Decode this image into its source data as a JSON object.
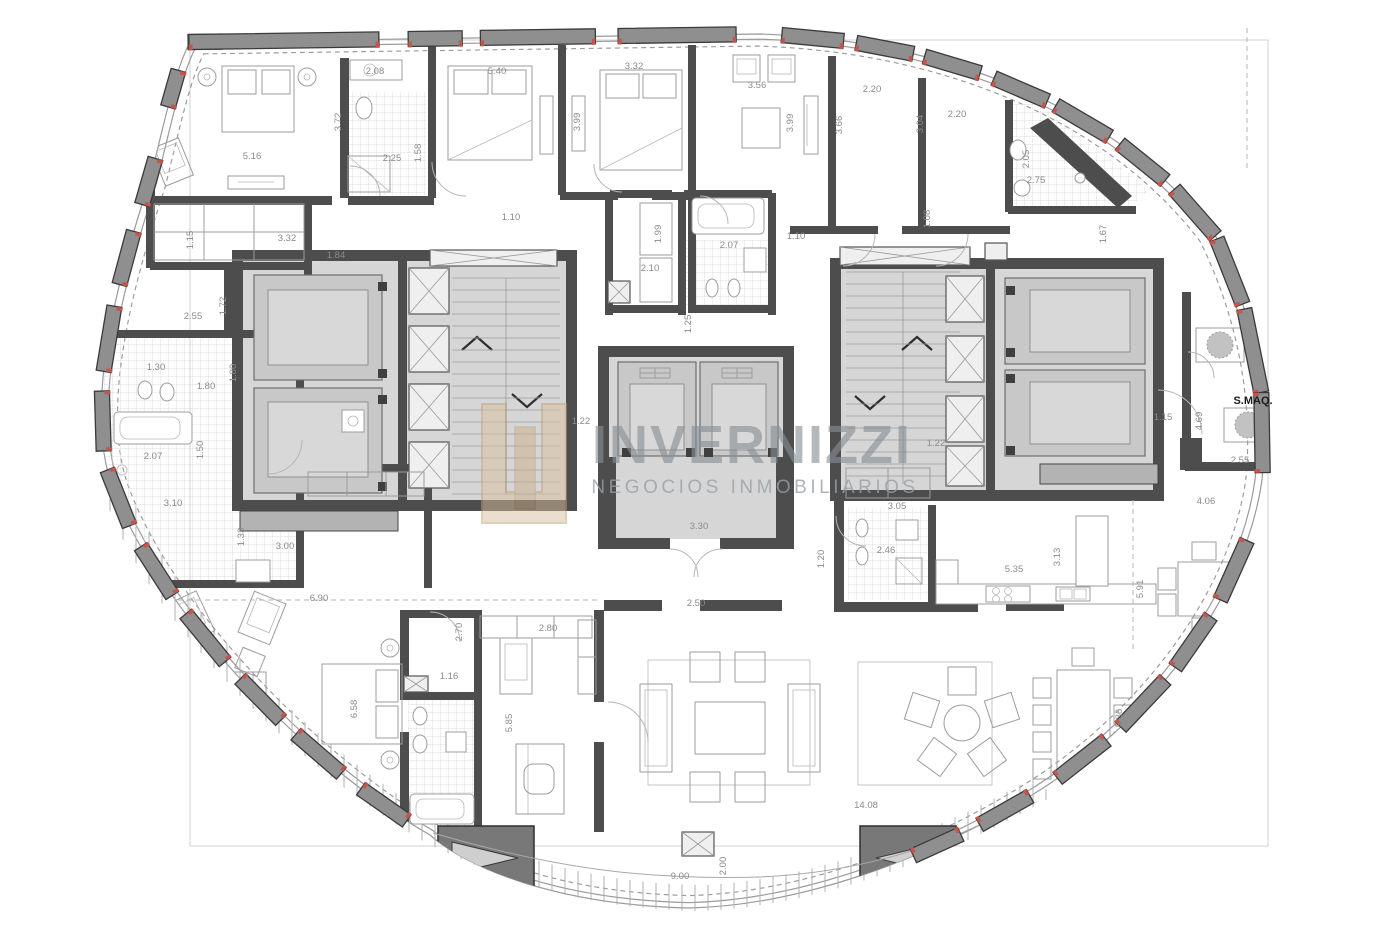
{
  "watermark": {
    "title": "INVERNIZZI",
    "subtitle": "NEGOCIOS INMOBILIARIOS"
  },
  "machine_room_label": "S.MAQ.",
  "colors": {
    "wall": "#4d4d4d",
    "pier_fill": "#8f8f8f",
    "pier_stroke": "#3a3a3a",
    "accent_red": "#c4544d",
    "core_fill": "#d6d6d6",
    "cabin_fill": "#c8c8c8",
    "watermark_text": "#878f95",
    "logo_tan": "#d9bf9b",
    "dimension_text": "#8b8b8b"
  },
  "labels": [
    {
      "t": "2.08",
      "x": 375,
      "y": 74
    },
    {
      "t": "5.40",
      "x": 497,
      "y": 74
    },
    {
      "t": "3.32",
      "x": 634,
      "y": 69
    },
    {
      "t": "3.56",
      "x": 757,
      "y": 88
    },
    {
      "t": "2.20",
      "x": 872,
      "y": 92
    },
    {
      "t": "2.20",
      "x": 957,
      "y": 117
    },
    {
      "t": "3.72",
      "x": 341,
      "y": 122,
      "r": -90
    },
    {
      "t": "1.58",
      "x": 421,
      "y": 153,
      "r": -90
    },
    {
      "t": "2.25",
      "x": 392,
      "y": 161
    },
    {
      "t": "5.16",
      "x": 252,
      "y": 159
    },
    {
      "t": "3.99",
      "x": 580,
      "y": 122,
      "r": -90
    },
    {
      "t": "3.99",
      "x": 793,
      "y": 123,
      "r": -90
    },
    {
      "t": "3.66",
      "x": 842,
      "y": 125,
      "r": -90
    },
    {
      "t": "3.04",
      "x": 923,
      "y": 124,
      "r": -90
    },
    {
      "t": "2.05",
      "x": 1029,
      "y": 159,
      "r": -90
    },
    {
      "t": "2.75",
      "x": 1036,
      "y": 183
    },
    {
      "t": "1.15",
      "x": 193,
      "y": 240,
      "r": -90
    },
    {
      "t": "3.32",
      "x": 287,
      "y": 241
    },
    {
      "t": "1.84",
      "x": 336,
      "y": 258
    },
    {
      "t": "1.72",
      "x": 226,
      "y": 306,
      "r": -90
    },
    {
      "t": "2.55",
      "x": 193,
      "y": 319
    },
    {
      "t": "1.10",
      "x": 511,
      "y": 220
    },
    {
      "t": "1.99",
      "x": 661,
      "y": 234,
      "r": -90
    },
    {
      "t": "2.10",
      "x": 650,
      "y": 271
    },
    {
      "t": "2.07",
      "x": 729,
      "y": 248
    },
    {
      "t": "1.10",
      "x": 796,
      "y": 239
    },
    {
      "t": "1.25",
      "x": 691,
      "y": 324,
      "r": -90
    },
    {
      "t": "1.08",
      "x": 930,
      "y": 219,
      "r": -90
    },
    {
      "t": "1.67",
      "x": 1106,
      "y": 234,
      "r": -90
    },
    {
      "t": "1.30",
      "x": 156,
      "y": 370
    },
    {
      "t": "1.80",
      "x": 236,
      "y": 373,
      "r": -90
    },
    {
      "t": "1.80",
      "x": 206,
      "y": 389
    },
    {
      "t": "2.07",
      "x": 153,
      "y": 459
    },
    {
      "t": "1.50",
      "x": 203,
      "y": 450,
      "r": -90
    },
    {
      "t": "3.10",
      "x": 173,
      "y": 506
    },
    {
      "t": "1.33",
      "x": 244,
      "y": 537,
      "r": -90
    },
    {
      "t": "3.00",
      "x": 285,
      "y": 549
    },
    {
      "t": "1.22",
      "x": 581,
      "y": 424
    },
    {
      "t": "1.22",
      "x": 936,
      "y": 446
    },
    {
      "t": "3.30",
      "x": 699,
      "y": 529
    },
    {
      "t": "1.20",
      "x": 824,
      "y": 559,
      "r": -90
    },
    {
      "t": "2.46",
      "x": 886,
      "y": 553
    },
    {
      "t": "3.05",
      "x": 897,
      "y": 509
    },
    {
      "t": "5.35",
      "x": 1014,
      "y": 572
    },
    {
      "t": "3.13",
      "x": 1060,
      "y": 557,
      "r": -90
    },
    {
      "t": "5.91",
      "x": 1143,
      "y": 589,
      "r": -90
    },
    {
      "t": "4.06",
      "x": 1206,
      "y": 504
    },
    {
      "t": "1.15",
      "x": 1163,
      "y": 420
    },
    {
      "t": "4.69",
      "x": 1202,
      "y": 421,
      "r": -90
    },
    {
      "t": "2.55",
      "x": 1240,
      "y": 463
    },
    {
      "t": "6.90",
      "x": 319,
      "y": 601
    },
    {
      "t": "2.50",
      "x": 696,
      "y": 606
    },
    {
      "t": "2.80",
      "x": 548,
      "y": 631
    },
    {
      "t": "2.70",
      "x": 462,
      "y": 632,
      "r": -90
    },
    {
      "t": "1.16",
      "x": 449,
      "y": 679
    },
    {
      "t": "6.58",
      "x": 357,
      "y": 709,
      "r": -90
    },
    {
      "t": "5.85",
      "x": 512,
      "y": 723,
      "r": -90
    },
    {
      "t": "14.08",
      "x": 866,
      "y": 808
    },
    {
      "t": "5.86",
      "x": 1122,
      "y": 718,
      "r": -90
    },
    {
      "t": "9.00",
      "x": 680,
      "y": 879
    },
    {
      "t": "2.00",
      "x": 726,
      "y": 866,
      "r": -90
    }
  ]
}
